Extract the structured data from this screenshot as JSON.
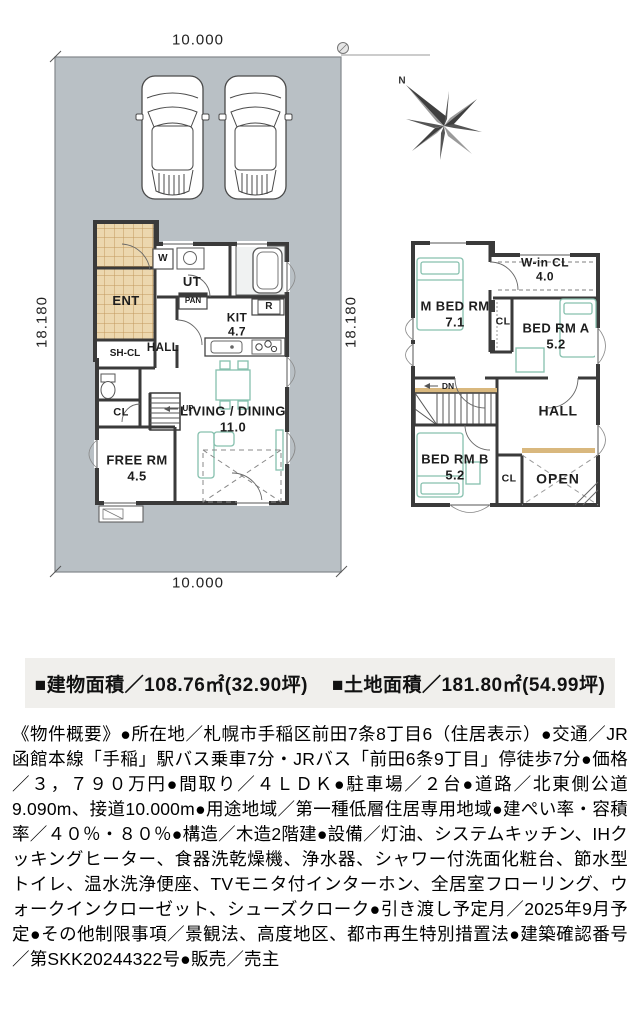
{
  "dimensions": {
    "top": "10.000",
    "bottom": "10.000",
    "left": "18.180",
    "right": "18.180"
  },
  "compass": {
    "north": "N"
  },
  "floor1": {
    "ent": "ENT",
    "w": "W",
    "ut": "UT",
    "pan": "PAN",
    "r": "R",
    "kit": "KIT",
    "kit_size": "4.7",
    "hall": "HALL",
    "shcl": "SH-CL",
    "cl": "CL",
    "up": "UP",
    "living": "LIVING / DINING",
    "living_size": "11.0",
    "free": "FREE RM",
    "free_size": "4.5"
  },
  "floor2": {
    "mbed": "M BED RM",
    "mbed_size": "7.1",
    "wincl": "W-in CL",
    "wincl_size": "4.0",
    "cl_a": "CL",
    "bed_a": "BED RM A",
    "bed_a_size": "5.2",
    "hall": "HALL",
    "dn": "DN",
    "bed_b": "BED RM B",
    "bed_b_size": "5.2",
    "cl_b": "CL",
    "open": "OPEN"
  },
  "banner": {
    "building_area": "■建物面積／108.76㎡(32.90坪)",
    "land_area": "■土地面積／181.80㎡(54.99坪)"
  },
  "description": {
    "text": "《物件概要》●所在地／札幌市手稲区前田7条8丁目6（住居表示）●交通／JR函館本線「手稲」駅バス乗車7分・JRバス「前田6条9丁目」停徒歩7分●価格／３，７９０万円●間取り／４ＬＤＫ●駐車場／２台●道路／北東側公道9.090m、接道10.000m●用途地域／第一種低層住居専用地域●建ぺい率・容積率／４０％・８０％●構造／木造2階建●設備／灯油、システムキッチン、IHクッキングヒーター、食器洗乾燥機、浄水器、シャワー付洗面化粧台、節水型トイレ、温水洗浄便座、TVモニタ付インターホン、全居室フローリング、ウォークインクローゼット、シューズクローク●引き渡し予定月／2025年9月予定●その他制限事項／景観法、高度地区、都市再生特別措置法●建築確認番号／第SKK20244322号●販売／売主"
  }
}
